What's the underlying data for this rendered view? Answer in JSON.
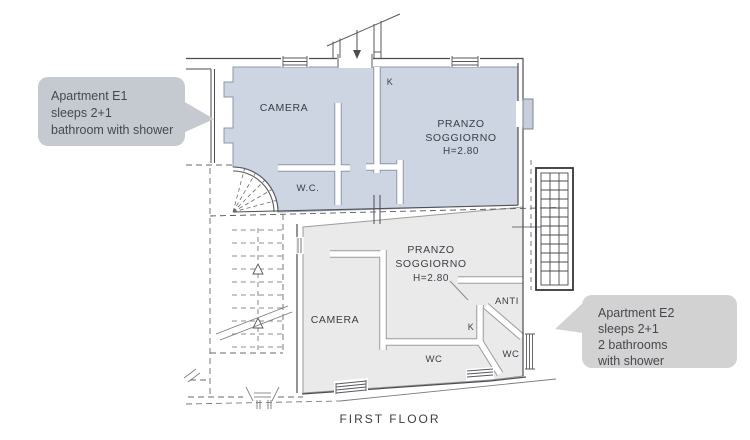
{
  "caption": "FIRST FLOOR",
  "callouts": {
    "e1": {
      "lines": [
        "Apartment E1",
        "sleeps 2+1",
        "bathroom with shower"
      ]
    },
    "e2": {
      "lines": [
        "Apartment E2",
        "sleeps 2+1",
        "2 bathrooms",
        "with shower"
      ]
    }
  },
  "apartments": {
    "e1": {
      "id": "E1",
      "fill": "#cdd4e2"
    },
    "e2": {
      "id": "E2",
      "fill": "#eaeaea"
    }
  },
  "labels": {
    "e1_camera": "CAMERA",
    "e1_k": "K",
    "e1_pranzo_1": "PRANZO",
    "e1_pranzo_2": "SOGGIORNO",
    "e1_pranzo_3": "H=2.80",
    "e1_wc": "W.C.",
    "e2_pranzo_1": "PRANZO",
    "e2_pranzo_2": "SOGGIORNO",
    "e2_pranzo_3": "H=2.80",
    "e2_camera": "CAMERA",
    "e2_anti": "ANTI",
    "e2_k": "K",
    "e2_wc_left": "WC",
    "e2_wc_right": "WC"
  },
  "colors": {
    "e1_fill": "#cdd4e2",
    "e2_fill": "#eaeaea",
    "e1_callout_bg": "#c5cad0",
    "e2_callout_bg": "#d2d2d3",
    "wall_line": "#4d4d52",
    "label_text": "#3a3f45"
  }
}
